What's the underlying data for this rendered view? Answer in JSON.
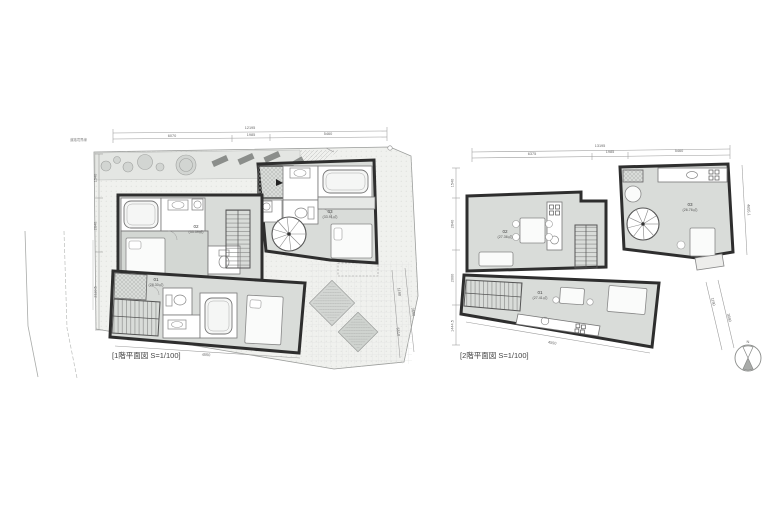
{
  "document": {
    "type": "architectural-floor-plan",
    "background": "#ffffff"
  },
  "colors": {
    "wall": "#2e2e2e",
    "room_fill": "#d9dcd9",
    "bedroom_fill": "#d3d7d3",
    "site_fill": "#f0f1ee",
    "fixture_fill": "#ffffff",
    "dim_line": "#9a9a9a",
    "text": "#555555"
  },
  "plan_1f": {
    "title": "[1階平面図 S=1/100]",
    "units": [
      {
        "id": "01",
        "area": "(28.30㎡)"
      },
      {
        "id": "02",
        "area": "(33.39㎡)"
      },
      {
        "id": "03",
        "area": "(33.91㎡)"
      }
    ],
    "dimensions": {
      "top_total": "12195",
      "top_segments": [
        "6070",
        "1985",
        "5460"
      ],
      "left": [
        "1540",
        "2640",
        "2110.5"
      ],
      "right_diagonal": [
        "1190",
        "3690",
        "5510"
      ],
      "bottom": "4550"
    },
    "annotations": {
      "boundary_note": "道路境界線"
    }
  },
  "plan_2f": {
    "title": "[2階平面図 S=1/100]",
    "units": [
      {
        "id": "01",
        "area": "(27.41㎡)"
      },
      {
        "id": "02",
        "area": "(27.36㎡)"
      },
      {
        "id": "03",
        "area": "(26.76㎡)"
      }
    ],
    "dimensions": {
      "top_total": "13195",
      "top_segments": [
        "6375",
        "1985",
        "5460"
      ],
      "left": [
        "1540",
        "2640",
        "2000",
        "1444.5"
      ],
      "right_vertical": "4655.1",
      "right_diagonal": [
        "1190",
        "3690"
      ],
      "bottom": "4550"
    },
    "compass_label": "N"
  }
}
